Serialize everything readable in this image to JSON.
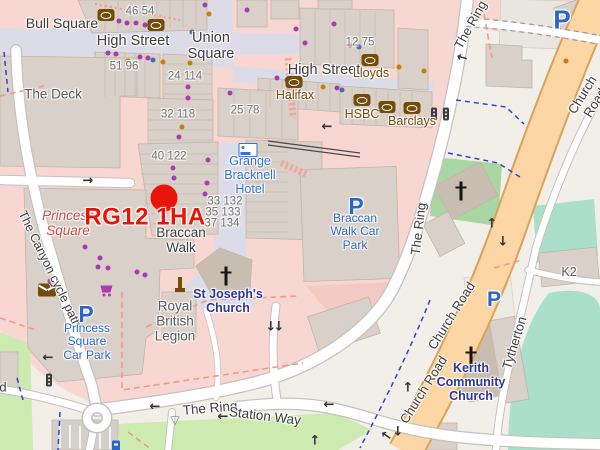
{
  "colors": {
    "land": "#f2efe9",
    "retail": "#f8d7d3",
    "retail_dark": "#f3c9c4",
    "building": "#d9d0c9",
    "building_stroke": "#c2b5a6",
    "church_building": "#c9bdb1",
    "ped": "#dcdce8",
    "road_casing": "#c4c2bf",
    "road_fill": "#ffffff",
    "primary": "#fcd6a4",
    "primary_casing": "#d9a35c",
    "grass": "#cdebb0",
    "pitch": "#aae0cb",
    "church_green": "#a8d5a1",
    "parking_lot": "#ebeae4",
    "plaza": "#e9e6df",
    "street_text": "#3d3d3d",
    "building_name_text": "#5a5a5a",
    "number_text": "#707070",
    "amenity_brown": "#734a08",
    "parking_blue": "#2a66c8",
    "hotel_blue": "#3272d9",
    "church_navy": "#2d3596",
    "retail_red": "#cf4a42",
    "marker_red": "#e91408",
    "poi_purple": "#a83cb0",
    "poi_orange": "#c87e0a",
    "poi_blue": "#4a6da8",
    "dashed_red": "#f29a8e",
    "steps_pink": "#f0a89e",
    "dashed_blue": "#3140d8",
    "arrow_dark": "#333333",
    "cross_black": "#151515",
    "traffic_light": "#3c3c3c",
    "giveway_gray": "#8a8a8a",
    "wall": "#4a4a4a"
  },
  "labels": [
    {
      "n": "street-label-bull-square",
      "t": "Bull Square",
      "x": 62,
      "y": 24,
      "c": "street",
      "s": 14
    },
    {
      "n": "street-label-high-street-west",
      "t": "High Street",
      "x": 133,
      "y": 41,
      "c": "street",
      "s": 14.5
    },
    {
      "n": "street-label-union-square",
      "t": "Union\nSquare",
      "x": 211,
      "y": 46,
      "c": "street",
      "s": 14.5
    },
    {
      "n": "street-label-high-street-east",
      "t": "High Street",
      "x": 324,
      "y": 70,
      "c": "street",
      "s": 14.5
    },
    {
      "n": "street-label-braccan-walk",
      "t": "Braccan\nWalk",
      "x": 181,
      "y": 240,
      "c": "street",
      "s": 13.5
    },
    {
      "n": "street-label-the-ring-north",
      "t": "The Ring",
      "x": 471,
      "y": 25,
      "c": "street",
      "s": 13,
      "r": -61
    },
    {
      "n": "street-label-the-ring-mid",
      "t": "The Ring",
      "x": 419,
      "y": 229,
      "c": "street",
      "s": 13,
      "r": -83
    },
    {
      "n": "street-label-the-ring-south",
      "t": "The Ring",
      "x": 210,
      "y": 408,
      "c": "street",
      "s": 13.5,
      "r": -5
    },
    {
      "n": "street-label-station-way",
      "t": "Station Way",
      "x": 265,
      "y": 416,
      "c": "street",
      "s": 13.5,
      "r": 7
    },
    {
      "n": "street-label-church-road-north",
      "t": "Church Road",
      "x": 589,
      "y": 99,
      "c": "street",
      "s": 13,
      "r": -58
    },
    {
      "n": "street-label-church-road-mid",
      "t": "Church Road",
      "x": 452,
      "y": 316,
      "c": "street",
      "s": 13,
      "r": -58
    },
    {
      "n": "street-label-church-road-south",
      "t": "Church Road",
      "x": 424,
      "y": 390,
      "c": "street",
      "s": 13,
      "r": -58
    },
    {
      "n": "street-label-canyon-cycle-path",
      "t": "The Canyon cycle path",
      "x": 50,
      "y": 269,
      "c": "street",
      "s": 12.5,
      "r": 64
    },
    {
      "n": "street-label-tytherton",
      "t": "Tytherton",
      "x": 515,
      "y": 343,
      "c": "street",
      "s": 13,
      "r": -73
    },
    {
      "n": "street-label-partial-d",
      "t": "d",
      "x": 3,
      "y": 388,
      "c": "street",
      "s": 13
    },
    {
      "n": "building-label-the-deck",
      "t": "The Deck",
      "x": 53,
      "y": 94,
      "c": "bname",
      "s": 13.5
    },
    {
      "n": "building-label-royal-british-legion",
      "t": "Royal\nBritish\nLegion",
      "x": 175,
      "y": 321,
      "c": "bname",
      "s": 13.5
    },
    {
      "n": "building-label-k2",
      "t": "K2",
      "x": 569,
      "y": 272,
      "c": "bname",
      "s": 12.5
    },
    {
      "n": "housenumber-46-54",
      "t": "46 54",
      "x": 140,
      "y": 12,
      "c": "num",
      "s": 11.5
    },
    {
      "n": "housenumber-51-96",
      "t": "51 96",
      "x": 124,
      "y": 67,
      "c": "num",
      "s": 11.5
    },
    {
      "n": "housenumber-24-114",
      "t": "24 114",
      "x": 185,
      "y": 77,
      "c": "num",
      "s": 11.5
    },
    {
      "n": "housenumber-32-118",
      "t": "32 118",
      "x": 178,
      "y": 115,
      "c": "num",
      "s": 11.5
    },
    {
      "n": "housenumber-12-75",
      "t": "12 75",
      "x": 360,
      "y": 43,
      "c": "num",
      "s": 11.5
    },
    {
      "n": "housenumber-25-78",
      "t": "25 78",
      "x": 245,
      "y": 111,
      "c": "num",
      "s": 11.5
    },
    {
      "n": "housenumber-40-122",
      "t": "40 122",
      "x": 169,
      "y": 157,
      "c": "num",
      "s": 11.5
    },
    {
      "n": "housenumber-33-132",
      "t": "33 132",
      "x": 225,
      "y": 202,
      "c": "num",
      "s": 11.5
    },
    {
      "n": "housenumber-35-133",
      "t": "35 133",
      "x": 223,
      "y": 213,
      "c": "num",
      "s": 11.5
    },
    {
      "n": "housenumber-37-134",
      "t": "37 134",
      "x": 222,
      "y": 224,
      "c": "num",
      "s": 11.5
    },
    {
      "n": "retail-label-princess-square",
      "t": "Princess\nSquare",
      "x": 68,
      "y": 223,
      "c": "retaill",
      "s": 13.5
    },
    {
      "n": "hotel-label-grange-bracknell",
      "t": "Grange\nBracknell\nHotel",
      "x": 250,
      "y": 175,
      "c": "hotell",
      "s": 12.5
    },
    {
      "n": "church-label-st-josephs",
      "t": "St Joseph's\nChurch",
      "x": 228,
      "y": 301,
      "c": "churchl",
      "s": 12.5
    },
    {
      "n": "church-label-kerith",
      "t": "Kerith\nCommunity\nChurch",
      "x": 471,
      "y": 382,
      "c": "churchl",
      "s": 12.5
    },
    {
      "n": "parking-label-braccan-walk",
      "t": "Braccan\nWalk Car\nPark",
      "x": 355,
      "y": 232,
      "c": "ptext",
      "s": 12
    },
    {
      "n": "parking-label-princess-square",
      "t": "Princess\nSquare\nCar Park",
      "x": 87,
      "y": 342,
      "c": "ptext",
      "s": 12
    },
    {
      "n": "parking-p-braccan",
      "t": "P",
      "x": 356,
      "y": 207,
      "c": "pletter",
      "s": 23
    },
    {
      "n": "parking-p-princess",
      "t": "P",
      "x": 86,
      "y": 315,
      "c": "pletter",
      "s": 23
    },
    {
      "n": "parking-p-northeast",
      "t": "P",
      "x": 562,
      "y": 20,
      "c": "pletter",
      "s": 26
    },
    {
      "n": "parking-p-east",
      "t": "P",
      "x": 494,
      "y": 300,
      "c": "pletter",
      "s": 21
    },
    {
      "n": "bank-label-lloyds",
      "t": "Lloyds",
      "x": 371,
      "y": 73,
      "c": "bankl",
      "s": 12.5
    },
    {
      "n": "bank-label-halifax",
      "t": "Halifax",
      "x": 295,
      "y": 95,
      "c": "bankl",
      "s": 12.5
    },
    {
      "n": "bank-label-hsbc",
      "t": "HSBC",
      "x": 362,
      "y": 114,
      "c": "bankl",
      "s": 12.5
    },
    {
      "n": "bank-label-barclays",
      "t": "Barclays",
      "x": 412,
      "y": 121,
      "c": "bankl",
      "s": 12.5
    },
    {
      "n": "postcode-label",
      "t": "RG12 1HA",
      "x": 145,
      "y": 218,
      "c": "postcode",
      "s": 24
    }
  ],
  "icons": [
    {
      "t": "bank",
      "n": "bank-icon",
      "x": 106,
      "y": 15
    },
    {
      "t": "bank",
      "n": "bank-icon",
      "x": 156,
      "y": 25
    },
    {
      "t": "bank",
      "n": "bank-icon",
      "x": 370,
      "y": 60
    },
    {
      "t": "bank",
      "n": "bank-icon",
      "x": 294,
      "y": 82
    },
    {
      "t": "bank",
      "n": "bank-icon",
      "x": 362,
      "y": 100
    },
    {
      "t": "bank",
      "n": "bank-icon",
      "x": 387,
      "y": 107
    },
    {
      "t": "bank",
      "n": "bank-icon",
      "x": 412,
      "y": 108
    },
    {
      "t": "hotel",
      "n": "hotel-icon",
      "x": 248,
      "y": 150
    },
    {
      "t": "post",
      "n": "post-office-icon",
      "x": 47,
      "y": 290
    },
    {
      "t": "cart",
      "n": "supermarket-icon",
      "x": 107,
      "y": 290
    },
    {
      "t": "memorial",
      "n": "memorial-icon",
      "x": 180,
      "y": 285
    },
    {
      "t": "cross",
      "n": "church-cross-icon",
      "x": 226,
      "y": 276
    },
    {
      "t": "cross",
      "n": "church-cross-icon",
      "x": 461,
      "y": 191
    },
    {
      "t": "cross",
      "n": "church-cross-icon",
      "x": 471,
      "y": 356
    },
    {
      "t": "tlight",
      "n": "traffic-light-icon",
      "x": 434,
      "y": 114
    },
    {
      "t": "tlight",
      "n": "traffic-light-icon",
      "x": 446,
      "y": 114
    },
    {
      "t": "tlight",
      "n": "traffic-light-icon",
      "x": 49,
      "y": 380
    },
    {
      "t": "pmeter",
      "n": "parking-meter-icon",
      "x": 116,
      "y": 446
    },
    {
      "t": "marker",
      "n": "postcode-marker-dot",
      "x": 164,
      "y": 198
    },
    {
      "t": "glyph",
      "n": "give-way-icon",
      "x": 175,
      "y": 420,
      "g": "▽"
    },
    {
      "t": "arrow",
      "n": "oneway-arrow-icon",
      "x": 88,
      "y": 181,
      "g": "→"
    },
    {
      "t": "arrow",
      "n": "oneway-arrow-icon",
      "x": 327,
      "y": 127,
      "g": "←"
    },
    {
      "t": "arrow",
      "n": "oneway-arrow-icon",
      "x": 48,
      "y": 358,
      "g": "←"
    },
    {
      "t": "arrow",
      "n": "oneway-arrow-icon",
      "x": 155,
      "y": 407,
      "g": "←"
    },
    {
      "t": "arrow",
      "n": "oneway-arrow-icon",
      "x": 223,
      "y": 417,
      "g": "←"
    },
    {
      "t": "arrow",
      "n": "oneway-arrow-icon",
      "x": 329,
      "y": 405,
      "g": "←"
    },
    {
      "t": "arrow",
      "n": "oneway-arrow-icon",
      "x": 315,
      "y": 441,
      "g": "↑"
    },
    {
      "t": "arrow",
      "n": "oneway-arrow-icon",
      "x": 271,
      "y": 327,
      "g": "↓"
    },
    {
      "t": "arrow",
      "n": "oneway-arrow-icon",
      "x": 279,
      "y": 327,
      "g": "↓"
    },
    {
      "t": "arrow",
      "n": "oneway-arrow-icon",
      "x": 492,
      "y": 224,
      "g": "↑"
    },
    {
      "t": "arrow",
      "n": "oneway-arrow-icon",
      "x": 503,
      "y": 242,
      "g": "↓"
    },
    {
      "t": "arrow",
      "n": "oneway-arrow-icon",
      "x": 408,
      "y": 388,
      "g": "↑"
    },
    {
      "t": "arrow",
      "n": "oneway-arrow-icon",
      "x": 398,
      "y": 432,
      "g": "↓"
    },
    {
      "t": "arrow",
      "n": "oneway-arrow-icon",
      "x": 386,
      "y": 436,
      "g": "←",
      "r": 35
    },
    {
      "t": "arrow",
      "n": "oneway-arrow-icon",
      "x": 462,
      "y": 58,
      "g": "←",
      "r": 15
    },
    {
      "t": "arrow",
      "n": "oneway-arrow-icon",
      "x": 423,
      "y": 205,
      "g": "←",
      "r": -10
    }
  ],
  "dots": [
    {
      "x": 119,
      "y": 21,
      "c": "dp"
    },
    {
      "x": 127,
      "y": 23,
      "c": "dp"
    },
    {
      "x": 136,
      "y": 23,
      "c": "dp"
    },
    {
      "x": 145,
      "y": 25,
      "c": "dp"
    },
    {
      "x": 205,
      "y": 5,
      "c": "dp"
    },
    {
      "x": 247,
      "y": 10,
      "c": "dp"
    },
    {
      "x": 296,
      "y": 29,
      "c": "dp"
    },
    {
      "x": 334,
      "y": 24,
      "c": "dp"
    },
    {
      "x": 108,
      "y": 53,
      "c": "dp"
    },
    {
      "x": 116,
      "y": 54,
      "c": "dp"
    },
    {
      "x": 140,
      "y": 57,
      "c": "dp"
    },
    {
      "x": 148,
      "y": 58,
      "c": "dp"
    },
    {
      "x": 305,
      "y": 43,
      "c": "dp"
    },
    {
      "x": 350,
      "y": 45,
      "c": "dp"
    },
    {
      "x": 188,
      "y": 87,
      "c": "dp"
    },
    {
      "x": 188,
      "y": 98,
      "c": "dp"
    },
    {
      "x": 179,
      "y": 137,
      "c": "dp"
    },
    {
      "x": 230,
      "y": 93,
      "c": "dp"
    },
    {
      "x": 277,
      "y": 78,
      "c": "dp"
    },
    {
      "x": 337,
      "y": 88,
      "c": "dp"
    },
    {
      "x": 208,
      "y": 160,
      "c": "dp"
    },
    {
      "x": 207,
      "y": 183,
      "c": "dp"
    },
    {
      "x": 205,
      "y": 194,
      "c": "dp"
    },
    {
      "x": 201,
      "y": 218,
      "c": "dp"
    },
    {
      "x": 173,
      "y": 168,
      "c": "dp"
    },
    {
      "x": 174,
      "y": 178,
      "c": "dp"
    },
    {
      "x": 85,
      "y": 247,
      "c": "dp"
    },
    {
      "x": 100,
      "y": 258,
      "c": "dp"
    },
    {
      "x": 98,
      "y": 267,
      "c": "dp"
    },
    {
      "x": 108,
      "y": 268,
      "c": "dp"
    },
    {
      "x": 137,
      "y": 272,
      "c": "dp"
    },
    {
      "x": 145,
      "y": 275,
      "c": "dp"
    },
    {
      "x": 50,
      "y": 281,
      "c": "dp"
    },
    {
      "x": 209,
      "y": 14,
      "c": "do"
    },
    {
      "x": 128,
      "y": 61,
      "c": "do"
    },
    {
      "x": 163,
      "y": 62,
      "c": "do"
    },
    {
      "x": 190,
      "y": 63,
      "c": "do"
    },
    {
      "x": 399,
      "y": 67,
      "c": "do"
    },
    {
      "x": 424,
      "y": 71,
      "c": "do"
    },
    {
      "x": 182,
      "y": 127,
      "c": "do"
    },
    {
      "x": 566,
      "y": 61,
      "c": "do"
    },
    {
      "x": 323,
      "y": 87,
      "c": "do"
    },
    {
      "x": 192,
      "y": 32,
      "c": "db"
    },
    {
      "x": 153,
      "y": 60,
      "c": "db"
    },
    {
      "x": 287,
      "y": 80,
      "c": "db"
    },
    {
      "x": 342,
      "y": 90,
      "c": "db"
    },
    {
      "x": 359,
      "y": 47,
      "c": "db"
    }
  ]
}
